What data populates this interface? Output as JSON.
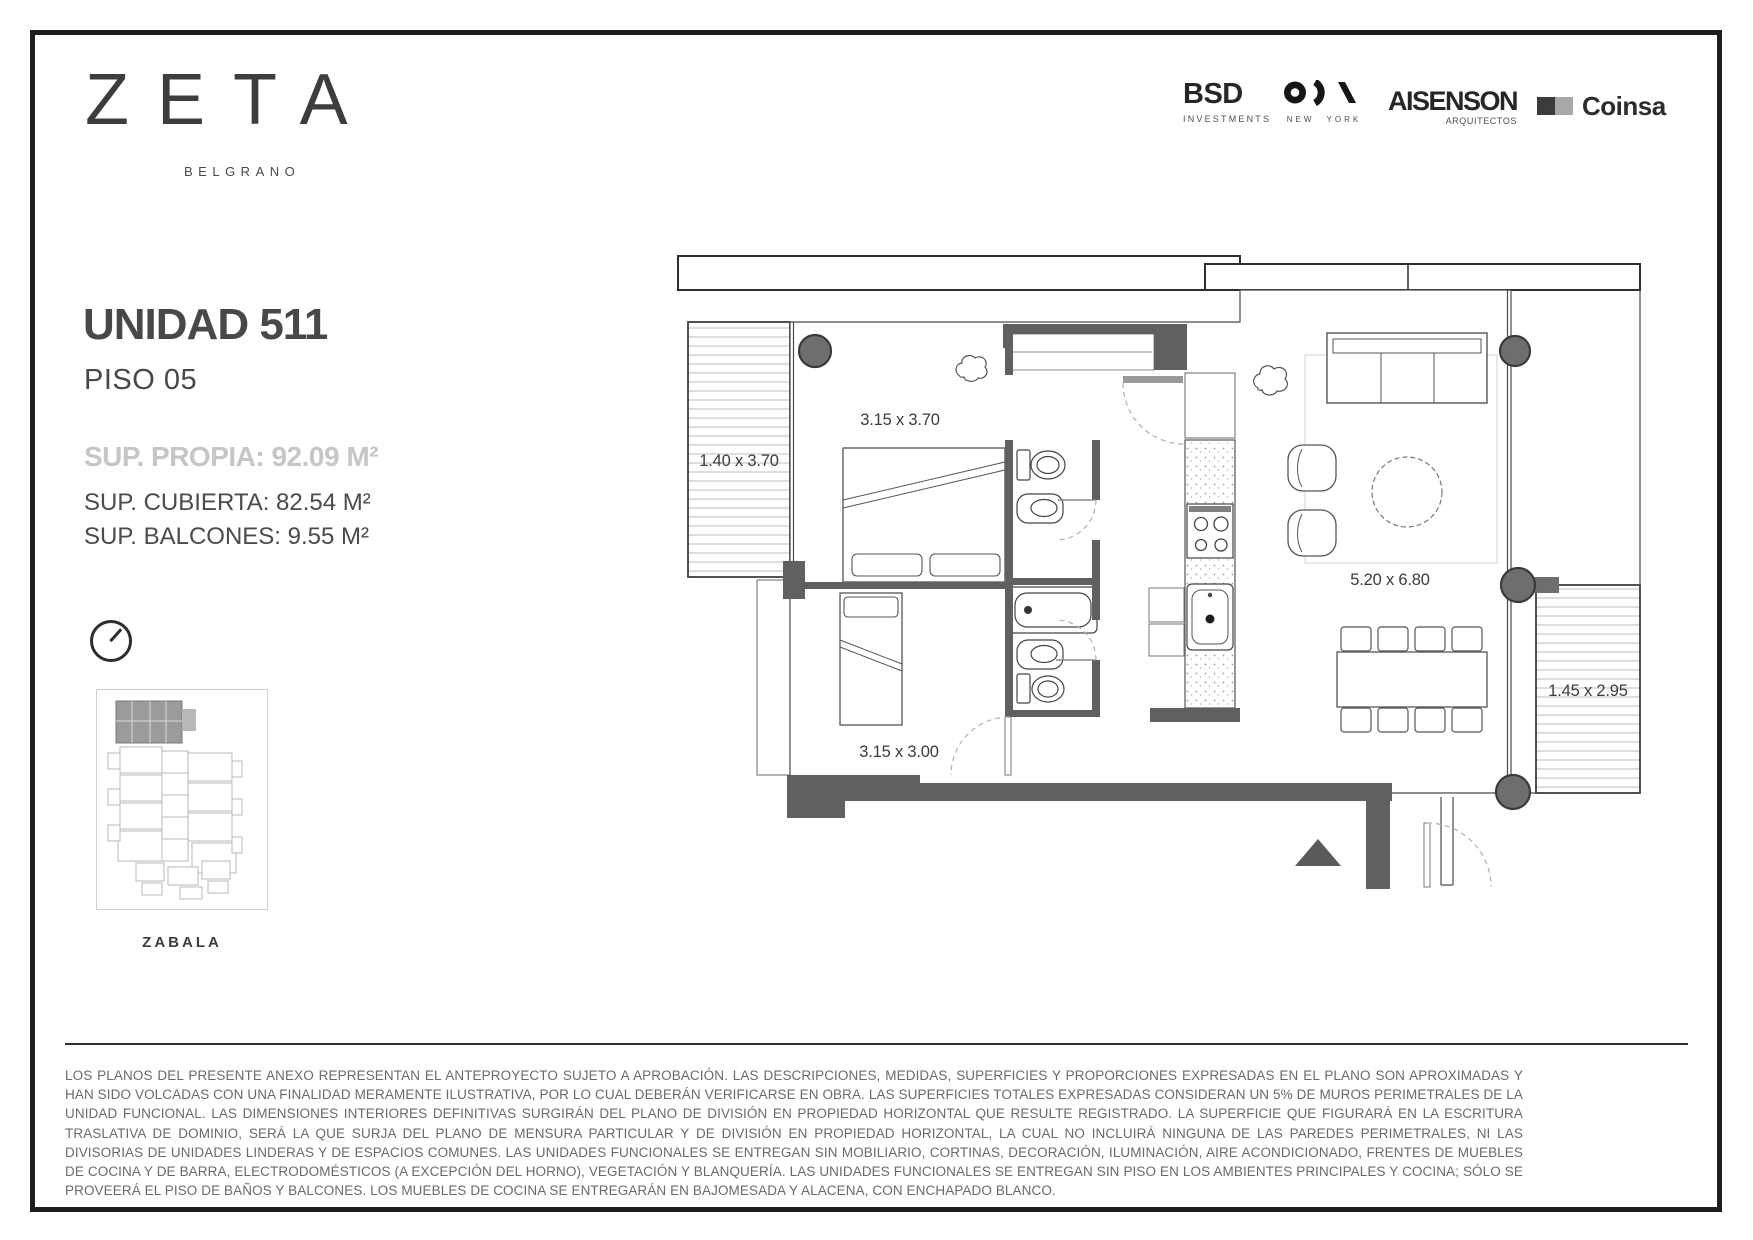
{
  "brand": {
    "name": "ZETA",
    "location": "BELGRANO"
  },
  "partners": {
    "bsd": {
      "name": "BSD",
      "tagline": "INVESTMENTS"
    },
    "oda": {
      "name": "ODA",
      "tagline": "NEW YORK",
      "icon": "oda-monogram"
    },
    "aisenson": {
      "name": "AISENSON",
      "tagline": "ARQUITECTOS"
    },
    "coinsa": {
      "name": "Coinsa",
      "icon": "two-squares"
    }
  },
  "unit": {
    "title": "UNIDAD 511",
    "floor": "PISO 05",
    "area_own": "SUP. PROPIA: 92.09 M²",
    "area_covered": "SUP. CUBIERTA: 82.54 M²",
    "area_balconies": "SUP. BALCONES: 9.55 M²"
  },
  "key_plan": {
    "street": "ZABALA"
  },
  "floor_plan": {
    "dims": {
      "balcony_left": "1.40 x 3.70",
      "bedroom_main": "3.15 x 3.70",
      "living": "5.20 x 6.80",
      "bedroom_second": "3.15 x 3.00",
      "balcony_right": "1.45 x 2.95"
    }
  },
  "footer": {
    "disclaimer": "LOS PLANOS DEL PRESENTE ANEXO REPRESENTAN EL ANTEPROYECTO SUJETO A APROBACIÓN. LAS DESCRIPCIONES, MEDIDAS, SUPERFICIES Y PROPORCIONES EXPRESADAS EN EL PLANO SON APROXIMADAS Y HAN SIDO VOLCADAS CON UNA FINALIDAD MERAMENTE ILUSTRATIVA, POR LO CUAL DEBERÁN VERIFICARSE EN OBRA. LAS SUPERFICIES TOTALES EXPRESADAS CONSIDERAN UN 5% DE MUROS PERIMETRALES DE LA UNIDAD FUNCIONAL. LAS DIMENSIONES INTERIORES DEFINITIVAS SURGIRÁN DEL PLANO DE DIVISIÓN EN PROPIEDAD HORIZONTAL QUE RESULTE REGISTRADO. LA SUPERFICIE QUE FIGURARÁ EN LA ESCRITURA TRASLATIVA DE DOMINIO, SERÁ LA QUE SURJA DEL PLANO DE MENSURA PARTICULAR Y DE DIVISIÓN EN PROPIEDAD HORIZONTAL, LA CUAL NO INCLUIRÁ NINGUNA DE LAS PAREDES PERIMETRALES, NI LAS DIVISORIAS DE UNIDADES LINDERAS Y DE ESPACIOS COMUNES. LAS UNIDADES FUNCIONALES SE ENTREGAN SIN MOBILIARIO, CORTINAS, DECORACIÓN, ILUMINACIÓN, AIRE ACONDICIONADO, FRENTES DE MUEBLES DE COCINA Y DE BARRA, ELECTRODOMÉSTICOS (A EXCEPCIÓN DEL HORNO), VEGETACIÓN Y BLANQUERÍA. LAS UNIDADES FUNCIONALES SE ENTREGAN SIN PISO EN LOS AMBIENTES PRINCIPALES Y COCINA; SÓLO SE PROVEERÁ EL PISO DE BAÑOS Y BALCONES. LOS MUEBLES DE COCINA SE ENTREGARÁN EN BAJOMESADA Y ALACENA, CON ENCHAPADO BLANCO."
  },
  "colors": {
    "wall_gray": "#606060",
    "column_gray": "#6e6e70",
    "text_dark": "#3c3c3e",
    "text_light_gray": "#c5c6c8",
    "frame_black": "#1e1e1e"
  }
}
